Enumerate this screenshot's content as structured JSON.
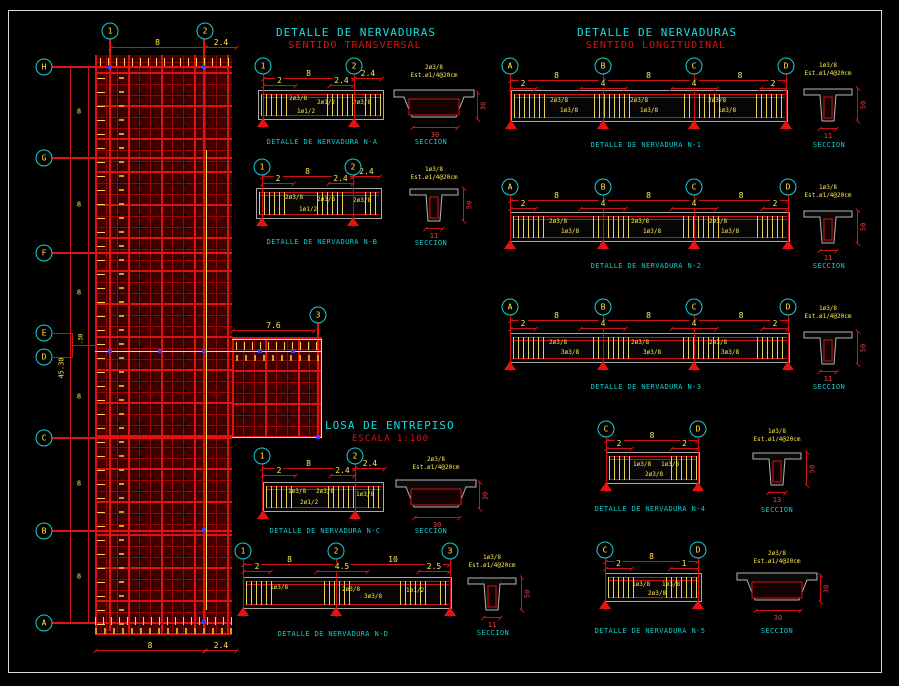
{
  "titles": {
    "transversal_1": "DETALLE DE NERVADURAS",
    "transversal_2": "SENTIDO TRANSVERSAL",
    "longitudinal_1": "DETALLE DE NERVADURAS",
    "longitudinal_2": "SENTIDO LONGITUDINAL"
  },
  "plan": {
    "label": "LOSA DE ENTREPISO",
    "scale": "ESCALA 1:100",
    "bubbles_top": [
      "1",
      "2"
    ],
    "bubble_mid": "3",
    "bubbles_rows": [
      "H",
      "G",
      "F",
      "E",
      "D",
      "C",
      "B",
      "A"
    ],
    "dim_top": [
      "8",
      "2.4"
    ],
    "dim_bottom": [
      "8",
      "2.4"
    ],
    "dim_left": [
      "8",
      "8",
      "8",
      "8",
      "8",
      "8"
    ],
    "dim_overall": "45.30",
    "dim_ed": ".30",
    "dim_ext": "7.6"
  },
  "colors": {
    "accent_red": "#e81111",
    "accent_yellow": "#ffe94a",
    "accent_cyan": "#16dede",
    "beam_gray": "#b5b5b5",
    "marker_blue": "#3742ff"
  },
  "details": [
    {
      "id": "N-A",
      "label": "DETALLE DE NERVADURA N-A",
      "bubbles": [
        "1",
        "2"
      ],
      "top_dims": [
        "8",
        "2.4"
      ],
      "sub_dims": [
        "2",
        "2.4"
      ],
      "callouts": [
        "2ø3/8",
        "2ø1/2",
        "1ø1/2",
        "2ø3/8"
      ],
      "section": {
        "label": "SECCION",
        "width": "30",
        "height": "30",
        "note1": "2ø3/8",
        "note2": "Est.ø1/4@20cm"
      }
    },
    {
      "id": "N-B",
      "label": "DETALLE DE NERVADURA N-B",
      "bubbles": [
        "1",
        "2"
      ],
      "top_dims": [
        "8",
        "2.4"
      ],
      "sub_dims": [
        "2",
        "2.4"
      ],
      "callouts": [
        "2ø3/8",
        "2ø3/8",
        "1ø1/2",
        "2ø3/8"
      ],
      "section": {
        "label": "SECCION",
        "width": "11",
        "height": "50",
        "note1": "1ø3/8",
        "note2": "Est.ø1/4@20cm"
      }
    },
    {
      "id": "N-C",
      "label": "DETALLE DE NERVADURA N-C",
      "bubbles": [
        "1",
        "2"
      ],
      "top_dims": [
        "8",
        "2.4"
      ],
      "sub_dims": [
        "2",
        "2.4"
      ],
      "callouts": [
        "1ø3/8",
        "2ø3/8",
        "2ø1/2",
        "1ø3/8"
      ],
      "section": {
        "label": "SECCION",
        "width": "30",
        "height": "30",
        "note1": "2ø3/8",
        "note2": "Est.ø1/4@20cm"
      }
    },
    {
      "id": "N-D",
      "label": "DETALLE DE NERVADURA N-D",
      "bubbles": [
        "1",
        "2",
        "3"
      ],
      "top_dims": [
        "8",
        "10"
      ],
      "sub_dims": [
        "2",
        "4.5",
        "2.5"
      ],
      "callouts": [
        "1ø3/8",
        "2ø3/8",
        "3ø3/8",
        "1ø1/2"
      ],
      "section": {
        "label": "SECCION",
        "width": "11",
        "height": "50",
        "note1": "1ø3/8",
        "note2": "Est.ø1/4@20cm"
      }
    },
    {
      "id": "N-1",
      "label": "DETALLE DE NERVADURA N-1",
      "bubbles": [
        "A",
        "B",
        "C",
        "D"
      ],
      "top_dims": [
        "8",
        "8",
        "8"
      ],
      "sub_dims": [
        "2",
        "4",
        "4",
        "2"
      ],
      "callouts": [
        "2ø3/8",
        "1ø3/8",
        "2ø3/8",
        "1ø3/8",
        "2ø3/8",
        "1ø3/8"
      ],
      "section": {
        "label": "SECCION",
        "width": "11",
        "height": "50",
        "note1": "1ø3/8",
        "note2": "Est.ø1/4@20cm"
      }
    },
    {
      "id": "N-2",
      "label": "DETALLE DE NERVADURA N-2",
      "bubbles": [
        "A",
        "B",
        "C",
        "D"
      ],
      "top_dims": [
        "8",
        "8",
        "8"
      ],
      "sub_dims": [
        "2",
        "4",
        "4",
        "2"
      ],
      "callouts": [
        "2ø3/8",
        "1ø3/8",
        "2ø3/8",
        "1ø3/8",
        "2ø3/8",
        "1ø3/8"
      ],
      "section": {
        "label": "SECCION",
        "width": "11",
        "height": "50",
        "note1": "1ø3/8",
        "note2": "Est.ø1/4@20cm"
      }
    },
    {
      "id": "N-3",
      "label": "DETALLE DE NERVADURA N-3",
      "bubbles": [
        "A",
        "B",
        "C",
        "D"
      ],
      "top_dims": [
        "8",
        "8",
        "8"
      ],
      "sub_dims": [
        "2",
        "4",
        "4",
        "2"
      ],
      "callouts": [
        "2ø3/8",
        "3ø3/8",
        "2ø3/8",
        "3ø3/8",
        "2ø3/8",
        "3ø3/8"
      ],
      "section": {
        "label": "SECCION",
        "width": "11",
        "height": "50",
        "note1": "1ø3/8",
        "note2": "Est.ø1/4@20cm"
      }
    },
    {
      "id": "N-4",
      "label": "DETALLE DE NERVADURA N-4",
      "bubbles": [
        "C",
        "D"
      ],
      "top_dims": [
        "8"
      ],
      "sub_dims": [
        "2",
        "2"
      ],
      "callouts": [
        "1ø3/8",
        "1ø3/8",
        "2ø3/8"
      ],
      "section": {
        "label": "SECCION",
        "width": "13",
        "height": "50",
        "note1": "1ø3/8",
        "note2": "Est.ø1/4@20cm"
      }
    },
    {
      "id": "N-5",
      "label": "DETALLE DE NERVADURA N-5",
      "bubbles": [
        "C",
        "D"
      ],
      "top_dims": [
        "8"
      ],
      "sub_dims": [
        "2",
        "1"
      ],
      "callouts": [
        "1ø3/8",
        "1ø3/8",
        "2ø3/8"
      ],
      "section": {
        "label": "SECCION",
        "width": "30",
        "height": "30",
        "note1": "2ø3/8",
        "note2": "Est.ø1/4@20cm"
      }
    }
  ]
}
